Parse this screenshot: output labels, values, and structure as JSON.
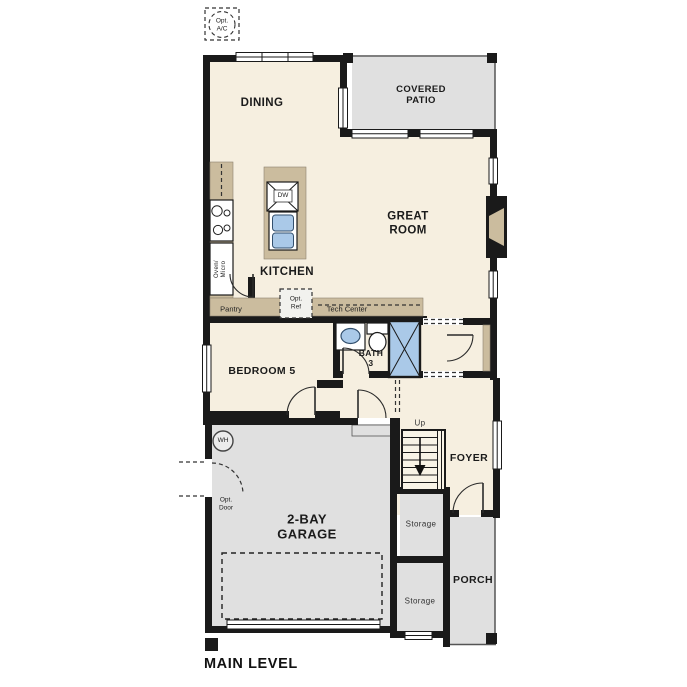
{
  "footer": {
    "title": "MAIN LEVEL"
  },
  "rooms": {
    "dining": "DINING",
    "covered_patio": "COVERED\nPATIO",
    "great_room": "GREAT\nROOM",
    "kitchen": "KITCHEN",
    "bedroom5": "BEDROOM 5",
    "bath3": "BATH\n3",
    "foyer": "FOYER",
    "garage": "2-BAY\nGARAGE",
    "porch": "PORCH",
    "storage_upper": "Storage",
    "storage_lower": "Storage"
  },
  "annotations": {
    "opt_ac": "Opt.\nA/C",
    "opt_ref": "Opt.\nRef",
    "opt_door": "Opt.\nDoor",
    "pantry": "Pantry",
    "tech_center": "Tech Center",
    "oven_micro": "Oven/\nMicro",
    "dishwasher": "DW",
    "water_heater": "WH",
    "stairs_up": "Up"
  },
  "colors": {
    "background": "#ffffff",
    "wall": "#1a1a1a",
    "interior": "#f6efe0",
    "outdoor": "#e0e0e0",
    "counter": "#cbbc9e",
    "fixture": "#aac9e8"
  }
}
